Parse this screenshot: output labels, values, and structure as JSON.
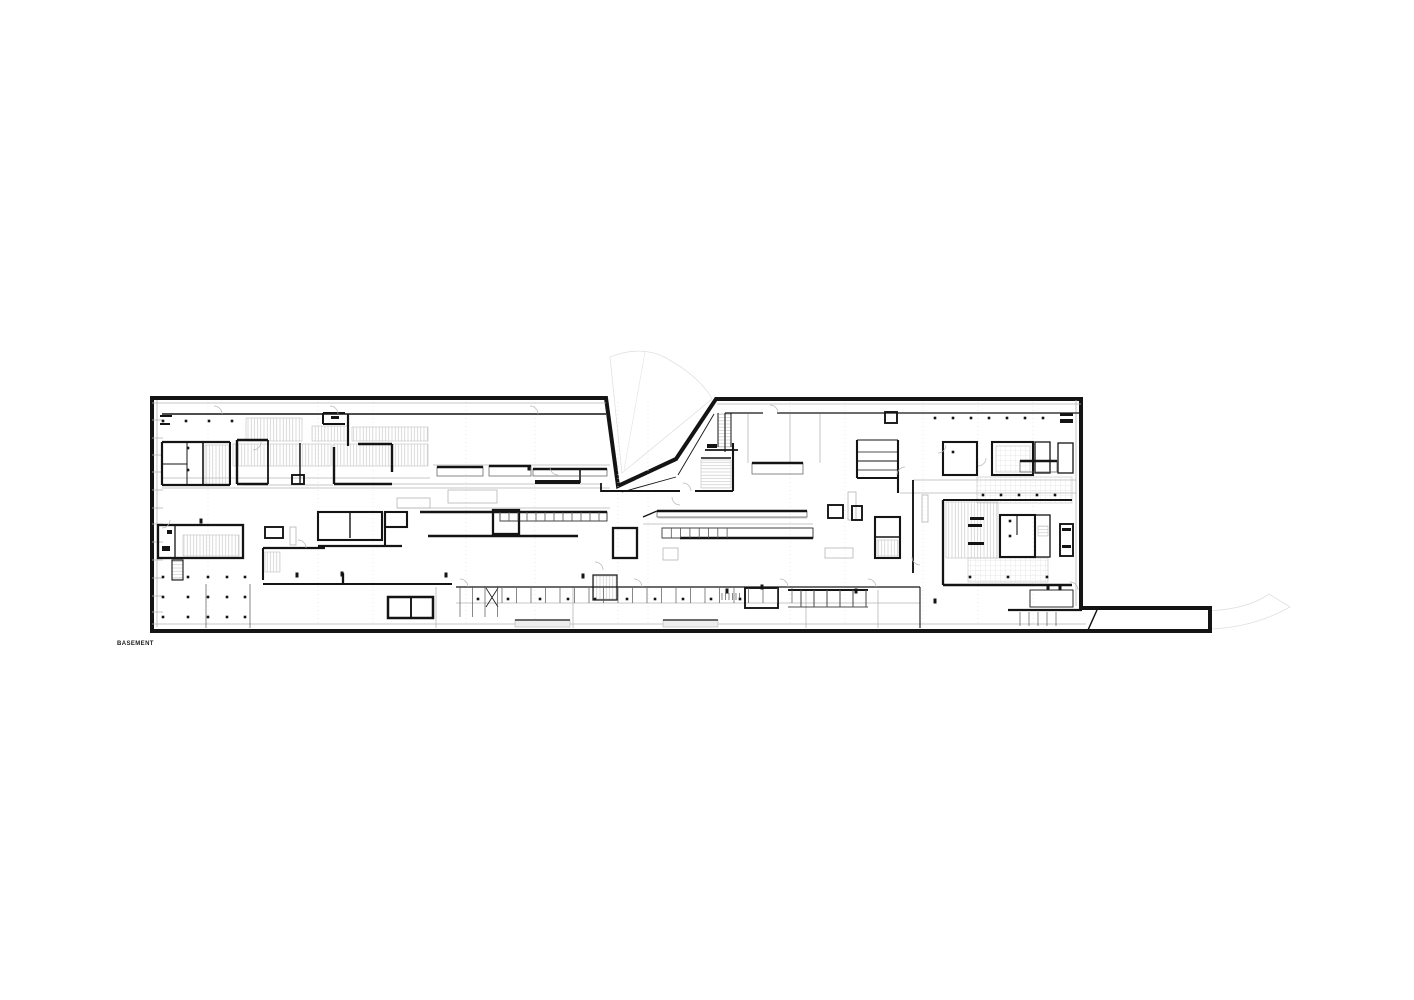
{
  "plan": {
    "label": "BASEMENT"
  },
  "colors": {
    "paper": "#ffffff",
    "ink": "#141414",
    "mid": "#555555",
    "light": "#b5b5b5",
    "faint": "#e1e1e1",
    "hatch": "#c4c4c4",
    "hatchLight": "#d6d6d6",
    "tableFill": "#ededed"
  },
  "drawing": {
    "width": 1414,
    "height": 1000,
    "outline": "M152,398 H606 L618,486 L676,459 L716,399 H1081 V608 H1210 V631 H152 Z",
    "fan": "M610,357 C630,349 650,349 666,358 C686,369 702,382 711,397 L712,399 L622,473 Z",
    "fanInner": "M645,352 L624,470",
    "curve": "M1210,611 C1240,609 1258,602 1269,594 L1290,607 C1265,621 1238,628 1210,629",
    "walls": [
      [
        162,
        442,
        230,
        442,
        2.2
      ],
      [
        162,
        442,
        162,
        485,
        2.2
      ],
      [
        162,
        485,
        230,
        485,
        2.2
      ],
      [
        230,
        442,
        230,
        485,
        2
      ],
      [
        187,
        442,
        187,
        485,
        1
      ],
      [
        203,
        442,
        203,
        485,
        1.6
      ],
      [
        162,
        464,
        187,
        464,
        1
      ],
      [
        160,
        416,
        172,
        416,
        2
      ],
      [
        160,
        424,
        170,
        424,
        2
      ],
      [
        237,
        440,
        237,
        484,
        2.4
      ],
      [
        237,
        440,
        268,
        440,
        2.4
      ],
      [
        268,
        440,
        268,
        484,
        1.8
      ],
      [
        237,
        484,
        268,
        484,
        2.4
      ],
      [
        300,
        443,
        300,
        484,
        1.4
      ],
      [
        323,
        413,
        345,
        413,
        2
      ],
      [
        323,
        413,
        323,
        424,
        2
      ],
      [
        323,
        424,
        345,
        424,
        2
      ],
      [
        348,
        414,
        348,
        446,
        2.2
      ],
      [
        358,
        444,
        392,
        444,
        2.4
      ],
      [
        392,
        444,
        392,
        472,
        2.4
      ],
      [
        334,
        447,
        334,
        484,
        2.4
      ],
      [
        334,
        484,
        392,
        484,
        2.4
      ],
      [
        162,
        414,
        606,
        414,
        1.6
      ],
      [
        725,
        413,
        763,
        413,
        1.3
      ],
      [
        777,
        413,
        1081,
        413,
        1.3
      ],
      [
        725,
        413,
        725,
        452,
        1.1
      ],
      [
        601,
        483,
        601,
        492,
        1.8
      ],
      [
        601,
        491,
        680,
        491,
        2.1
      ],
      [
        695,
        491,
        733,
        491,
        2.1
      ],
      [
        733,
        443,
        733,
        491,
        2.1
      ],
      [
        718,
        413,
        718,
        447,
        1
      ],
      [
        731,
        413,
        731,
        447,
        1
      ],
      [
        705,
        450,
        738,
        450,
        1.8
      ],
      [
        701,
        458,
        731,
        458,
        1.6
      ],
      [
        622,
        492,
        676,
        477,
        0.9
      ],
      [
        678,
        475,
        714,
        414,
        0.9
      ],
      [
        420,
        512,
        607,
        512,
        2.5
      ],
      [
        428,
        536,
        578,
        536,
        2.6
      ],
      [
        535,
        482,
        580,
        482,
        4
      ],
      [
        580,
        469,
        580,
        483,
        1.6
      ],
      [
        680,
        538,
        813,
        538,
        2.6
      ],
      [
        643,
        517,
        657,
        511,
        1.4
      ],
      [
        263,
        584,
        452,
        584,
        2.1
      ],
      [
        456,
        587,
        920,
        587,
        1.3
      ],
      [
        263,
        548,
        325,
        548,
        2.3
      ],
      [
        263,
        548,
        263,
        580,
        2.1
      ],
      [
        318,
        546,
        402,
        546,
        2.3
      ],
      [
        385,
        512,
        385,
        547,
        2.1
      ],
      [
        343,
        573,
        343,
        584,
        2.3
      ],
      [
        913,
        480,
        913,
        573,
        1.9
      ],
      [
        857,
        440,
        857,
        478,
        2.1
      ],
      [
        857,
        478,
        898,
        478,
        2.1
      ],
      [
        898,
        440,
        898,
        493,
        2.1
      ],
      [
        857,
        440,
        898,
        440,
        0.9
      ],
      [
        857,
        452,
        898,
        452,
        0.7
      ],
      [
        857,
        461,
        898,
        461,
        0.9
      ],
      [
        857,
        470,
        898,
        470,
        0.7
      ],
      [
        943,
        500,
        943,
        585,
        2.3
      ],
      [
        943,
        585,
        1072,
        585,
        2.5
      ],
      [
        943,
        500,
        1072,
        500,
        1.9
      ],
      [
        1008,
        610,
        1082,
        610,
        2.3
      ],
      [
        788,
        590,
        868,
        590,
        2.1
      ],
      [
        788,
        607,
        868,
        607,
        0.7
      ],
      [
        1088,
        630,
        1097,
        610,
        1.5
      ],
      [
        486,
        588,
        498,
        607,
        0.8
      ],
      [
        498,
        588,
        486,
        607,
        0.8
      ],
      [
        920,
        587,
        920,
        628,
        1.1
      ],
      [
        411,
        597,
        411,
        618,
        1.9
      ],
      [
        875,
        537,
        900,
        537,
        1.4
      ],
      [
        1017,
        515,
        1017,
        535,
        1.1
      ],
      [
        175,
        525,
        175,
        558,
        1.3
      ],
      [
        350,
        512,
        350,
        538,
        1.4
      ]
    ],
    "rects": [
      [
        388,
        597,
        45,
        21,
        2.5
      ],
      [
        493,
        510,
        26,
        24,
        2.3
      ],
      [
        613,
        528,
        24,
        30,
        2.3
      ],
      [
        828,
        505,
        15,
        13,
        1.9
      ],
      [
        852,
        506,
        10,
        14,
        1.9
      ],
      [
        875,
        517,
        25,
        41,
        2.1
      ],
      [
        745,
        588,
        33,
        20,
        1.9
      ],
      [
        943,
        442,
        34,
        33,
        2.1
      ],
      [
        992,
        442,
        41,
        33,
        2.1
      ],
      [
        1035,
        442,
        15,
        31,
        1.3
      ],
      [
        1058,
        443,
        15,
        30,
        1.3
      ],
      [
        1000,
        515,
        35,
        42,
        2.1
      ],
      [
        1035,
        515,
        15,
        42,
        1.3
      ],
      [
        1060,
        524,
        13,
        32,
        1.9
      ],
      [
        1030,
        590,
        43,
        17,
        0.9
      ],
      [
        158,
        525,
        85,
        33,
        2.3
      ],
      [
        172,
        560,
        11,
        20,
        1.1
      ],
      [
        265,
        527,
        18,
        11,
        1.9
      ],
      [
        292,
        475,
        12,
        9,
        1.9
      ],
      [
        385,
        512,
        22,
        15,
        2.1
      ],
      [
        593,
        575,
        24,
        25,
        1.2
      ],
      [
        885,
        412,
        12,
        11,
        1.9
      ],
      [
        318,
        512,
        64,
        28,
        2.1
      ],
      [
        662,
        528,
        151,
        10,
        0.8
      ],
      [
        500,
        512,
        107,
        9,
        0.8
      ]
    ],
    "lightRects": [
      [
        663,
        548,
        15,
        12
      ],
      [
        825,
        548,
        28,
        10
      ],
      [
        848,
        492,
        8,
        28
      ],
      [
        922,
        495,
        6,
        27
      ],
      [
        397,
        498,
        33,
        10
      ],
      [
        448,
        490,
        49,
        13
      ],
      [
        290,
        527,
        6,
        18
      ]
    ],
    "counters": [
      [
        437,
        467,
        46,
        9
      ],
      [
        489,
        466,
        42,
        10
      ],
      [
        533,
        469,
        74,
        7
      ],
      [
        657,
        511,
        150,
        6
      ],
      [
        752,
        463,
        51,
        11
      ],
      [
        1020,
        461,
        37,
        11
      ]
    ],
    "tickGroups": [
      {
        "x1": 500,
        "x2": 605,
        "step": 9,
        "y1": 512,
        "y2": 521,
        "w": 0.8
      },
      {
        "x1": 662,
        "x2": 736,
        "step": 9.3,
        "y1": 528,
        "y2": 538,
        "w": 0.8
      },
      {
        "x1": 502,
        "x2": 792,
        "step": 14.5,
        "y1": 588,
        "y2": 603,
        "w": 0.7
      },
      {
        "x1": 1020,
        "x2": 1056,
        "step": 9,
        "y1": 612,
        "y2": 626,
        "w": 0.7
      },
      {
        "x1": 722,
        "x2": 740,
        "step": 3.5,
        "y1": 593,
        "y2": 600,
        "w": 0.7
      },
      {
        "x1": 460,
        "x2": 498,
        "step": 12.5,
        "y1": 586,
        "y2": 617,
        "w": 0.7
      },
      {
        "x1": 801,
        "x2": 866,
        "step": 13,
        "y1": 590,
        "y2": 607,
        "w": 1.1
      },
      {
        "x1": 206,
        "x2": 250,
        "step": 44,
        "y1": 584,
        "y2": 628,
        "w": 0.7
      }
    ],
    "hatches": [
      [
        246,
        418,
        56,
        23,
        "v"
      ],
      [
        312,
        426,
        36,
        15,
        "v"
      ],
      [
        352,
        427,
        76,
        14,
        "v"
      ],
      [
        233,
        444,
        98,
        22,
        "v"
      ],
      [
        333,
        444,
        95,
        22,
        "v"
      ],
      [
        205,
        445,
        25,
        39,
        "v"
      ],
      [
        718,
        414,
        13,
        33,
        "h"
      ],
      [
        701,
        460,
        30,
        28,
        "h"
      ],
      [
        265,
        552,
        15,
        20,
        "v"
      ],
      [
        172,
        561,
        11,
        18,
        "h"
      ],
      [
        593,
        576,
        24,
        23,
        "v"
      ],
      [
        183,
        535,
        56,
        21,
        "v"
      ],
      [
        877,
        540,
        21,
        16,
        "v"
      ],
      [
        996,
        446,
        34,
        26,
        "g"
      ],
      [
        946,
        502,
        52,
        56,
        "v"
      ],
      [
        977,
        477,
        95,
        26,
        "g"
      ],
      [
        968,
        558,
        80,
        24,
        "g"
      ],
      [
        1038,
        526,
        10,
        10,
        "h"
      ]
    ],
    "dots": [
      [
        163,
        421
      ],
      [
        186,
        421
      ],
      [
        209,
        421
      ],
      [
        232,
        421
      ],
      [
        935,
        418
      ],
      [
        953,
        418
      ],
      [
        971,
        418
      ],
      [
        989,
        418
      ],
      [
        1007,
        418
      ],
      [
        1025,
        418
      ],
      [
        1043,
        418
      ],
      [
        983,
        495
      ],
      [
        1001,
        495
      ],
      [
        1019,
        495
      ],
      [
        1037,
        495
      ],
      [
        1055,
        495
      ],
      [
        970,
        577
      ],
      [
        1008,
        577
      ],
      [
        1047,
        577
      ],
      [
        163,
        577
      ],
      [
        188,
        577
      ],
      [
        208,
        577
      ],
      [
        227,
        577
      ],
      [
        245,
        577
      ],
      [
        163,
        597
      ],
      [
        188,
        597
      ],
      [
        208,
        597
      ],
      [
        227,
        597
      ],
      [
        245,
        597
      ],
      [
        163,
        617
      ],
      [
        188,
        617
      ],
      [
        208,
        617
      ],
      [
        227,
        617
      ],
      [
        245,
        617
      ],
      [
        478,
        599
      ],
      [
        508,
        599
      ],
      [
        540,
        599
      ],
      [
        568,
        599
      ],
      [
        595,
        599
      ],
      [
        627,
        599
      ],
      [
        655,
        599
      ],
      [
        683,
        599
      ],
      [
        711,
        599
      ],
      [
        740,
        599
      ],
      [
        953,
        452
      ],
      [
        1010,
        521
      ],
      [
        1010,
        536
      ],
      [
        188,
        448
      ],
      [
        188,
        470
      ]
    ],
    "jambs": [
      [
        297,
        575
      ],
      [
        342,
        574
      ],
      [
        446,
        575
      ],
      [
        583,
        576
      ],
      [
        727,
        591
      ],
      [
        762,
        587
      ],
      [
        856,
        591
      ],
      [
        935,
        601
      ],
      [
        1048,
        587
      ],
      [
        201,
        521
      ],
      [
        529,
        468
      ],
      [
        1060,
        588
      ]
    ],
    "fills": [
      [
        167,
        530,
        5,
        4
      ],
      [
        162,
        546,
        8,
        5
      ],
      [
        970,
        517,
        14,
        3
      ],
      [
        968,
        524,
        14,
        3
      ],
      [
        968,
        542,
        16,
        3
      ],
      [
        1060,
        413,
        13,
        3
      ],
      [
        1060,
        419,
        13,
        4
      ],
      [
        1062,
        528,
        9,
        3
      ],
      [
        1062,
        545,
        9,
        3
      ],
      [
        331,
        416,
        8,
        3
      ],
      [
        707,
        444,
        10,
        4
      ]
    ],
    "lightLines": [
      [
        152,
        403,
        606,
        403
      ],
      [
        717,
        404,
        1081,
        404
      ],
      [
        162,
        488,
        610,
        488
      ],
      [
        397,
        508,
        610,
        508
      ],
      [
        162,
        478,
        430,
        478
      ],
      [
        433,
        465,
        610,
        465
      ],
      [
        658,
        518,
        807,
        518
      ],
      [
        643,
        524,
        813,
        524
      ],
      [
        913,
        480,
        1076,
        480
      ],
      [
        900,
        493,
        1076,
        493
      ],
      [
        152,
        624,
        1086,
        624
      ],
      [
        1076,
        400,
        1076,
        606
      ],
      [
        157,
        400,
        157,
        627
      ],
      [
        456,
        603,
        920,
        603
      ],
      [
        436,
        587,
        436,
        628
      ],
      [
        573,
        587,
        573,
        628
      ],
      [
        806,
        590,
        806,
        628
      ],
      [
        878,
        590,
        878,
        628
      ],
      [
        243,
        485,
        333,
        485
      ],
      [
        392,
        484,
        601,
        484
      ],
      [
        748,
        414,
        748,
        463
      ],
      [
        790,
        414,
        790,
        463
      ],
      [
        820,
        414,
        820,
        463
      ],
      [
        152,
        420,
        163,
        420
      ],
      [
        152,
        438,
        163,
        438
      ],
      [
        152,
        455,
        163,
        455
      ],
      [
        152,
        472,
        163,
        472
      ],
      [
        152,
        490,
        163,
        490
      ],
      [
        152,
        508,
        163,
        508
      ],
      [
        152,
        524,
        163,
        524
      ],
      [
        152,
        542,
        163,
        542
      ],
      [
        152,
        560,
        163,
        560
      ],
      [
        152,
        578,
        163,
        578
      ],
      [
        152,
        596,
        163,
        596
      ],
      [
        152,
        612,
        163,
        612
      ]
    ],
    "dottedXs": [
      208,
      318,
      373,
      466,
      535,
      618,
      648,
      790,
      845,
      923,
      978,
      1033
    ],
    "dottedY": [
      402,
      626
    ],
    "tables": [
      [
        515,
        620,
        55,
        7
      ],
      [
        663,
        620,
        55,
        7
      ]
    ],
    "arcs": [
      [
        214,
        414,
        0
      ],
      [
        330,
        414,
        0
      ],
      [
        530,
        414,
        0
      ],
      [
        558,
        467,
        2
      ],
      [
        683,
        491,
        0
      ],
      [
        770,
        413,
        0
      ],
      [
        905,
        475,
        3
      ],
      [
        938,
        445,
        1
      ],
      [
        978,
        458,
        1
      ],
      [
        298,
        548,
        0
      ],
      [
        460,
        587,
        0
      ],
      [
        634,
        587,
        0
      ],
      [
        780,
        587,
        0
      ],
      [
        868,
        587,
        0
      ],
      [
        253,
        442,
        1
      ],
      [
        162,
        520,
        1
      ],
      [
        920,
        557,
        2
      ],
      [
        1070,
        590,
        0
      ],
      [
        595,
        570,
        0
      ],
      [
        680,
        497,
        2
      ]
    ]
  }
}
